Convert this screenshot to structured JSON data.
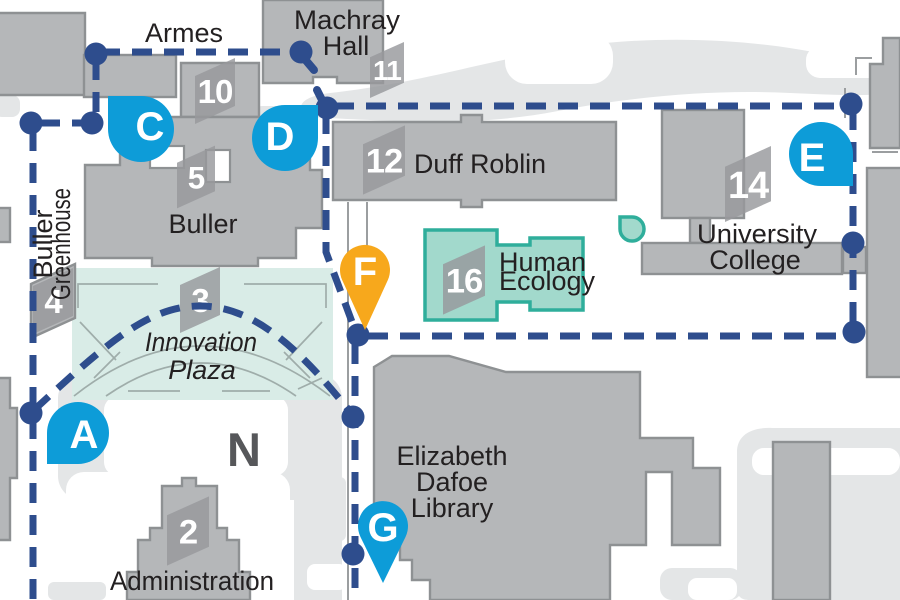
{
  "labels": {
    "armes": "Armes",
    "machray1": "Machray",
    "machray2": "Hall",
    "duff_roblin": "Duff Roblin",
    "buller": "Buller",
    "greenhouse1": "Buller",
    "greenhouse2": "Greenhouse",
    "university1": "University",
    "university2": "College",
    "human1": "Human",
    "human2": "Ecology",
    "plaza1": "Innovation",
    "plaza2": "Plaza",
    "dafoe1": "Elizabeth",
    "dafoe2": "Dafoe",
    "dafoe3": "Library",
    "administration": "Administration",
    "north": "N"
  },
  "badges": {
    "b10": "10",
    "b11": "11",
    "b5": "5",
    "b4": "4",
    "b3": "3",
    "b2": "2",
    "b12": "12",
    "b14": "14",
    "b16": "16"
  },
  "markers": {
    "a": "A",
    "c": "C",
    "d": "D",
    "e": "E",
    "f": "F",
    "g": "G"
  },
  "colors": {
    "route_navy": "#2e4d8d",
    "marker_blue": "#0d9cd8",
    "marker_orange": "#f7a81c",
    "teal_fill": "#a2d9cc",
    "teal_border": "#2fae9b",
    "plaza_fill": "#d9ece7",
    "building_gray": "#b5b7b9",
    "building_border": "#8e9193",
    "road_gray": "#e4e6e7",
    "label_text": "#232021",
    "north_gray": "#56575a"
  }
}
